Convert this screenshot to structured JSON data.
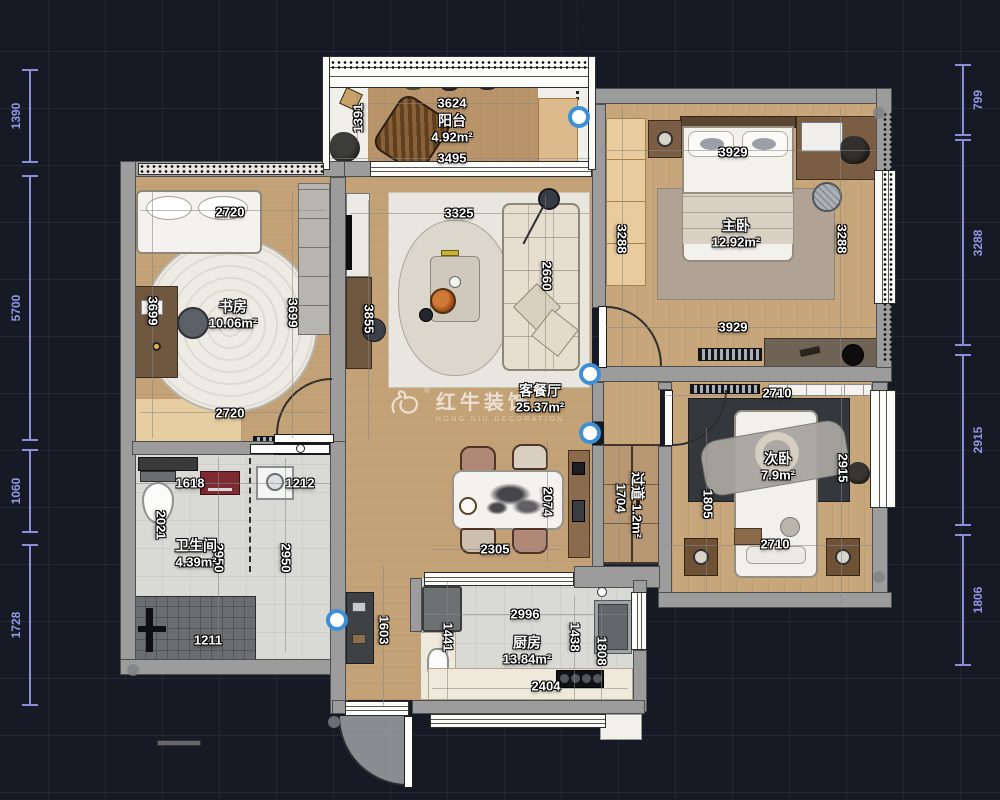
{
  "watermark": {
    "title": "红牛装饰",
    "subtitle": "HONG NIU DECORATION",
    "registered": "®"
  },
  "room_labels": [
    {
      "name": "阳台",
      "area": "4.92m²",
      "x": 452,
      "y": 129,
      "rot": 0
    },
    {
      "name": "书房",
      "area": "10.06m²",
      "x": 233,
      "y": 315,
      "rot": 0
    },
    {
      "name": "客餐厅",
      "area": "25.37m²",
      "x": 540,
      "y": 399,
      "rot": 0
    },
    {
      "name": "主卧",
      "area": "12.92m²",
      "x": 736,
      "y": 234,
      "rot": 0
    },
    {
      "name": "次卧",
      "area": "7.9m²",
      "x": 778,
      "y": 467,
      "rot": 0
    },
    {
      "name": "卫生间",
      "area": "4.39m²",
      "x": 196,
      "y": 554,
      "rot": 0
    },
    {
      "name": "厨房",
      "area": "13.84m²",
      "x": 527,
      "y": 651,
      "rot": 0
    },
    {
      "name": "过道",
      "area": "1.2m²",
      "x": 637,
      "y": 505,
      "rot": 90
    }
  ],
  "dimension_labels": [
    {
      "text": "3624",
      "x": 452,
      "y": 103,
      "rot": 0
    },
    {
      "text": "3495",
      "x": 452,
      "y": 158,
      "rot": 0
    },
    {
      "text": "1391",
      "x": 358,
      "y": 118,
      "rot": -90
    },
    {
      "text": "2720",
      "x": 230,
      "y": 212,
      "rot": 0
    },
    {
      "text": "3699",
      "x": 153,
      "y": 311,
      "rot": 90
    },
    {
      "text": "3699",
      "x": 293,
      "y": 313,
      "rot": 90
    },
    {
      "text": "3855",
      "x": 369,
      "y": 319,
      "rot": 90
    },
    {
      "text": "2720",
      "x": 230,
      "y": 413,
      "rot": 0
    },
    {
      "text": "3325",
      "x": 459,
      "y": 213,
      "rot": 0
    },
    {
      "text": "2660",
      "x": 547,
      "y": 276,
      "rot": 90
    },
    {
      "text": "3929",
      "x": 733,
      "y": 152,
      "rot": 0
    },
    {
      "text": "3288",
      "x": 622,
      "y": 239,
      "rot": 90
    },
    {
      "text": "3288",
      "x": 842,
      "y": 239,
      "rot": 90
    },
    {
      "text": "3929",
      "x": 733,
      "y": 327,
      "rot": 0
    },
    {
      "text": "2710",
      "x": 777,
      "y": 393,
      "rot": 0
    },
    {
      "text": "1805",
      "x": 708,
      "y": 504,
      "rot": 90
    },
    {
      "text": "2915",
      "x": 843,
      "y": 468,
      "rot": 90
    },
    {
      "text": "2710",
      "x": 775,
      "y": 544,
      "rot": 0
    },
    {
      "text": "1704",
      "x": 621,
      "y": 498,
      "rot": 90
    },
    {
      "text": "2074",
      "x": 548,
      "y": 502,
      "rot": 90
    },
    {
      "text": "2305",
      "x": 495,
      "y": 549,
      "rot": 0
    },
    {
      "text": "1618",
      "x": 190,
      "y": 483,
      "rot": 0
    },
    {
      "text": "1212",
      "x": 300,
      "y": 483,
      "rot": 0
    },
    {
      "text": "2021",
      "x": 161,
      "y": 525,
      "rot": 90
    },
    {
      "text": "2950",
      "x": 219,
      "y": 558,
      "rot": 90
    },
    {
      "text": "2950",
      "x": 286,
      "y": 558,
      "rot": 90
    },
    {
      "text": "1211",
      "x": 208,
      "y": 640,
      "rot": 0
    },
    {
      "text": "2996",
      "x": 525,
      "y": 614,
      "rot": 0
    },
    {
      "text": "1438",
      "x": 575,
      "y": 637,
      "rot": 90
    },
    {
      "text": "1808",
      "x": 602,
      "y": 651,
      "rot": 90
    },
    {
      "text": "2404",
      "x": 546,
      "y": 686,
      "rot": 0
    },
    {
      "text": "1441",
      "x": 448,
      "y": 637,
      "rot": 90
    },
    {
      "text": "1603",
      "x": 384,
      "y": 630,
      "rot": 90
    }
  ],
  "edge_dimensions": {
    "left": [
      {
        "text": "1390",
        "from": 70,
        "to": 162
      },
      {
        "text": "5700",
        "from": 176,
        "to": 440
      },
      {
        "text": "1060",
        "from": 450,
        "to": 532
      },
      {
        "text": "1728",
        "from": 545,
        "to": 705
      }
    ],
    "right": [
      {
        "text": "799",
        "from": 65,
        "to": 135
      },
      {
        "text": "3288",
        "from": 140,
        "to": 345
      },
      {
        "text": "2915",
        "from": 355,
        "to": 525
      },
      {
        "text": "1806",
        "from": 535,
        "to": 665
      }
    ]
  },
  "markers": {
    "blue_dots": [
      {
        "x": 575,
        "y": 113
      },
      {
        "x": 586,
        "y": 370
      },
      {
        "x": 586,
        "y": 429
      },
      {
        "x": 333,
        "y": 616
      }
    ]
  },
  "colors": {
    "background": "#151a25",
    "grid": "#2a3145",
    "wall": "#9c9c9c",
    "wood_floor": "#c3a277",
    "tile_floor": "#d9d9d5",
    "dim_line": "#8a8edc",
    "label_text": "#ffffff",
    "marker_blue": "#3d8fd6"
  }
}
